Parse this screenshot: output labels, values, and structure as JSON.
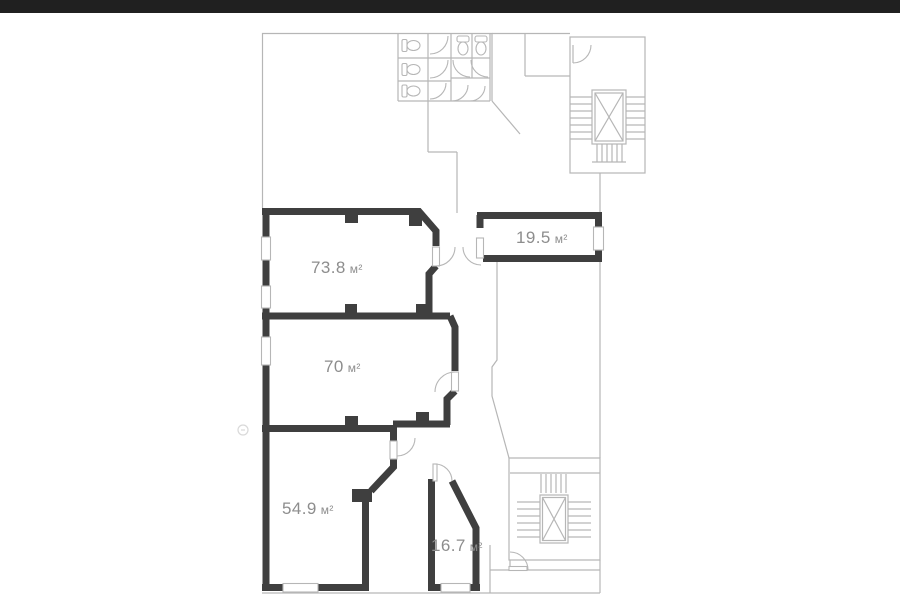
{
  "floorplan": {
    "kind": "floor-plan",
    "rooms": [
      {
        "id": "room-73-8",
        "area": "73.8",
        "unit": "м²"
      },
      {
        "id": "room-19-5",
        "area": "19.5",
        "unit": "м²"
      },
      {
        "id": "room-70",
        "area": "70",
        "unit": "м²"
      },
      {
        "id": "room-54-9",
        "area": "54.9",
        "unit": "м²"
      },
      {
        "id": "room-16-7",
        "area": "16.7",
        "unit": "м²"
      }
    ],
    "features": [
      "wc-block-with-three-stalls",
      "two-wc-stalls-top",
      "stairwell-top-with-elevator",
      "stairwell-bottom-with-elevator",
      "entrance-door-bottom",
      "windows-in-exterior-walls"
    ],
    "colors": {
      "wall": "#3f3f3f",
      "outline": "#b6b6b6",
      "label": "#8d8d8d",
      "background": "#ffffff",
      "top_bar": "#202020"
    }
  }
}
